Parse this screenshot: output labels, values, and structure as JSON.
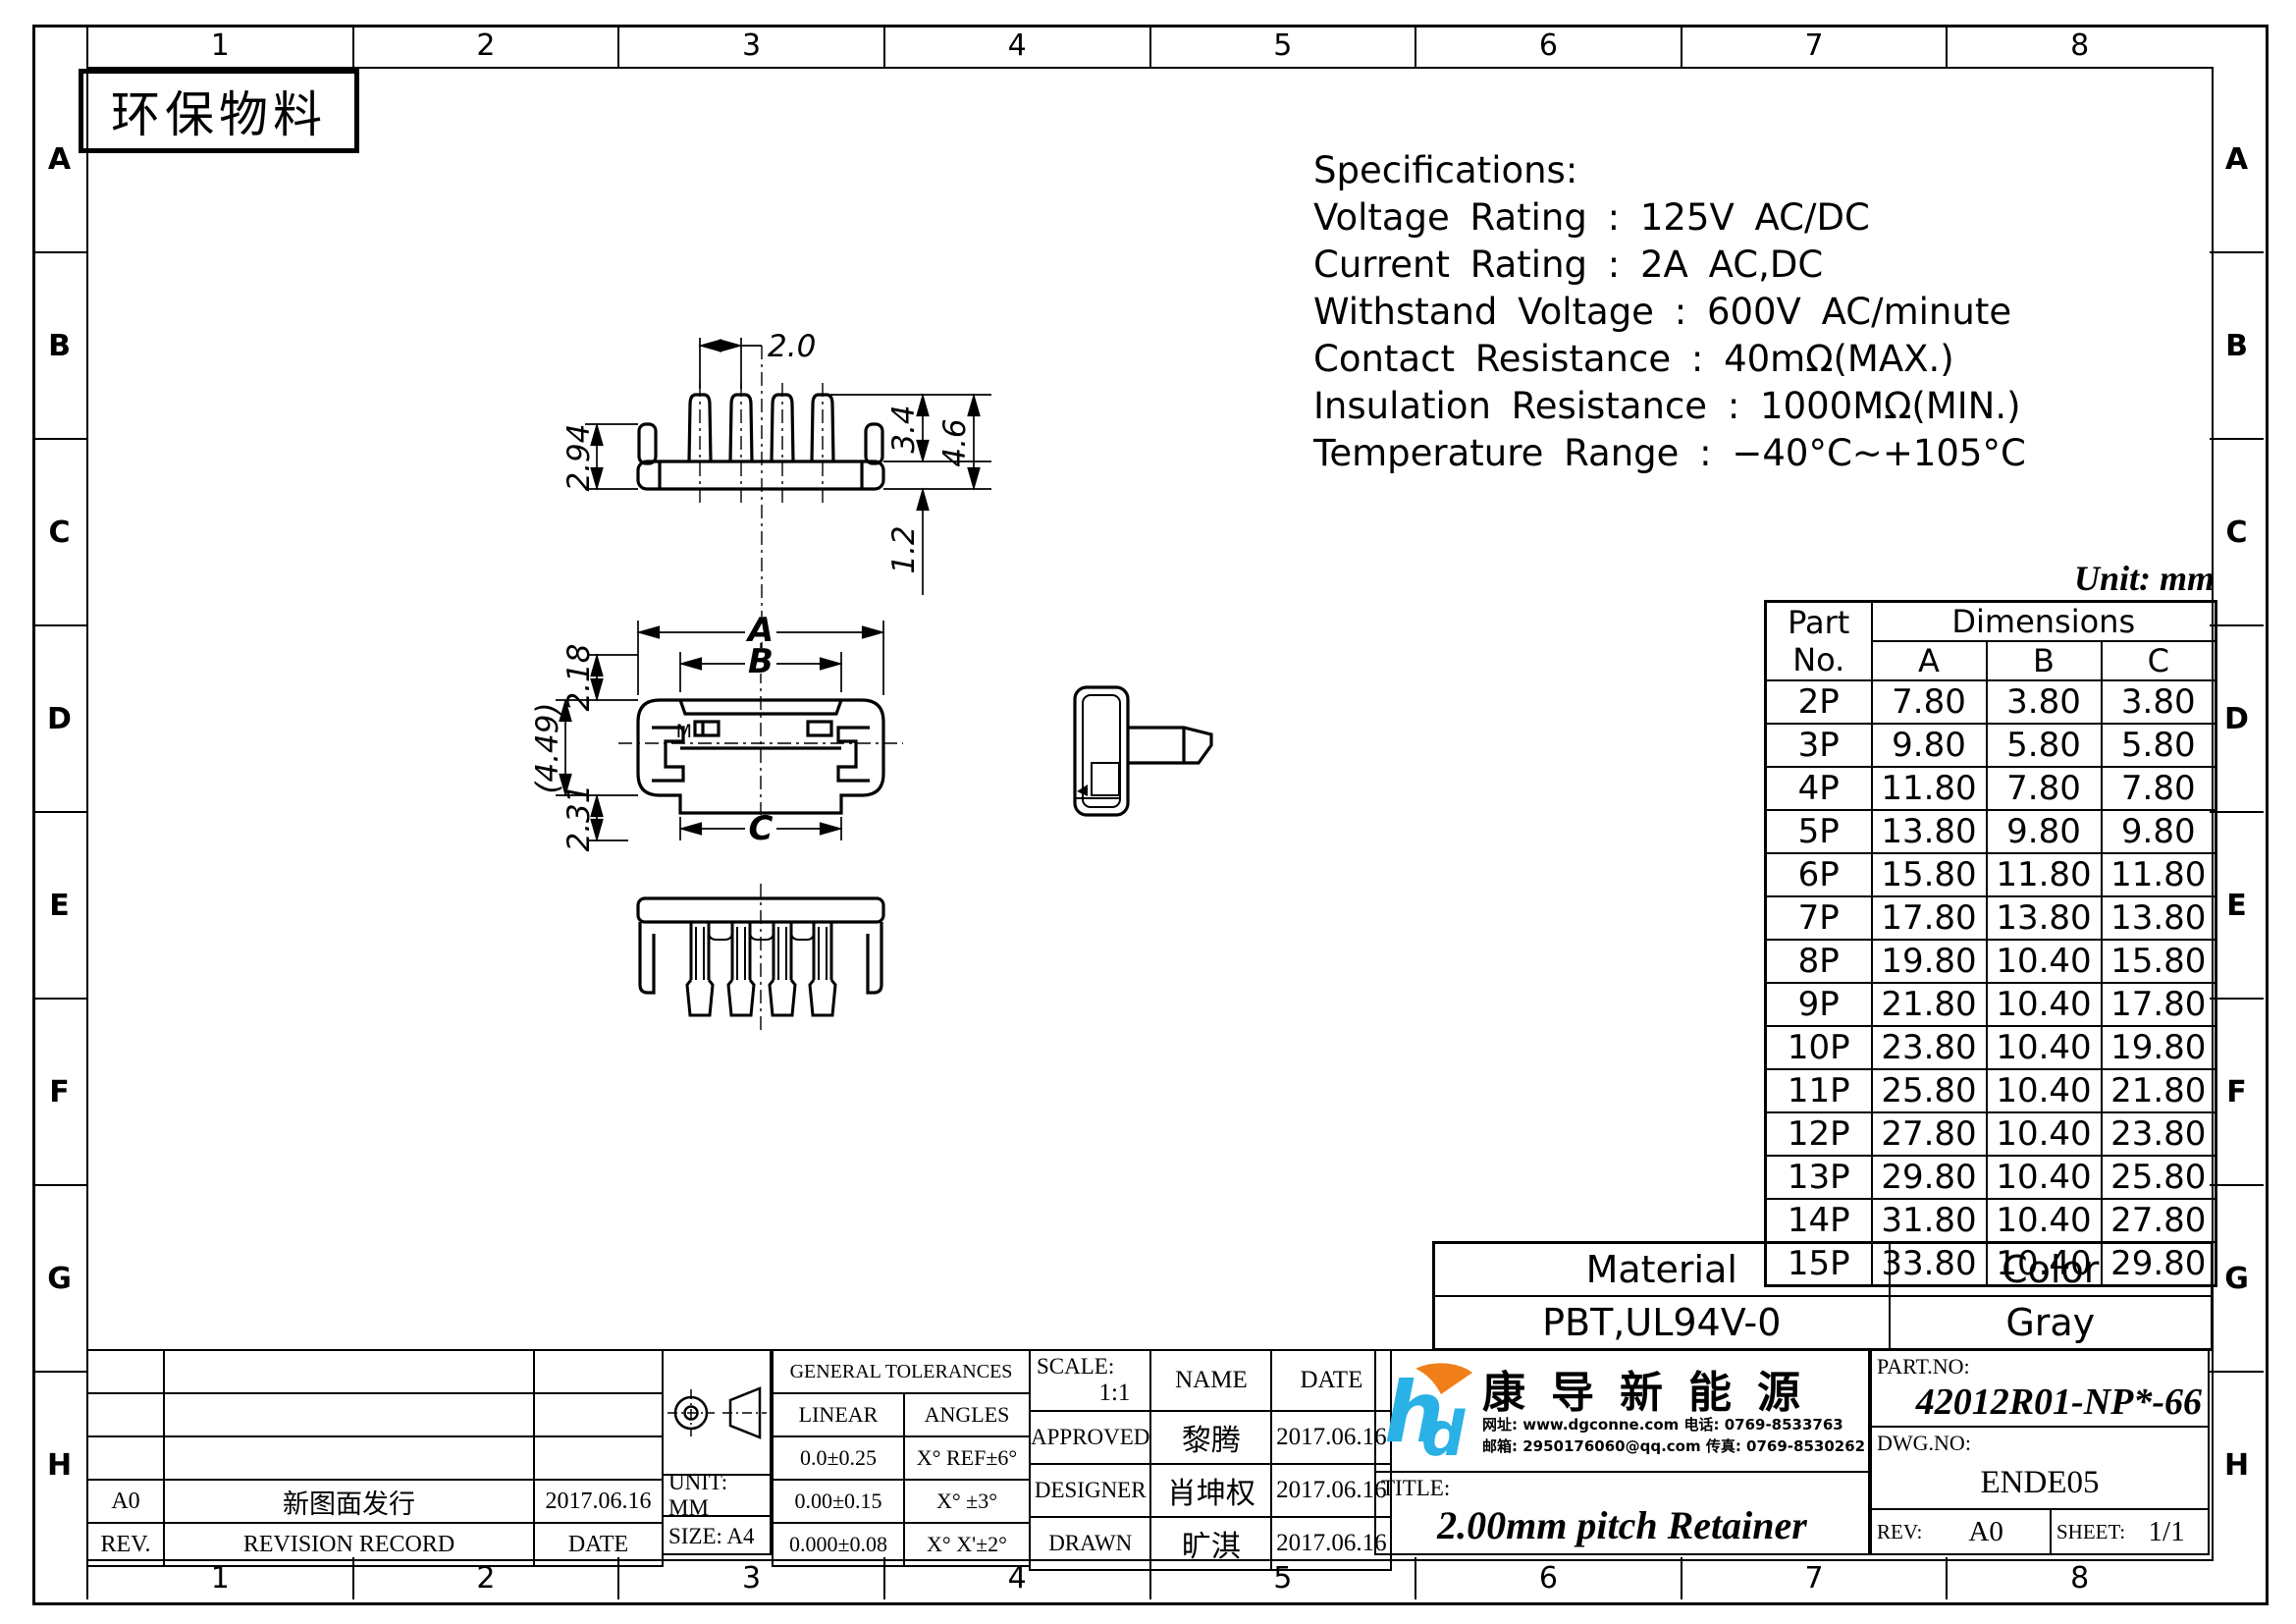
{
  "page": {
    "stamp": "环保物料",
    "unit_note": "Unit: mm"
  },
  "zones": {
    "columns": [
      "1",
      "2",
      "3",
      "4",
      "5",
      "6",
      "7",
      "8"
    ],
    "rows": [
      "A",
      "B",
      "C",
      "D",
      "E",
      "F",
      "G",
      "H"
    ]
  },
  "specifications": {
    "title": "Specifications:",
    "lines": [
      "Voltage Rating : 125V AC/DC",
      "Current Rating : 2A AC,DC",
      "Withstand Voltage : 600V AC/minute",
      "Contact Resistance : 40mΩ(MAX.)",
      "Insulation Resistance : 1000MΩ(MIN.)",
      "Temperature Range : −40°C~+105°C"
    ]
  },
  "dimensions_table": {
    "header_part": "Part",
    "header_no": "No.",
    "header_dims": "Dimensions",
    "columns": [
      "A",
      "B",
      "C"
    ],
    "rows": [
      {
        "part": "2P",
        "a": "7.80",
        "b": "3.80",
        "c": "3.80"
      },
      {
        "part": "3P",
        "a": "9.80",
        "b": "5.80",
        "c": "5.80"
      },
      {
        "part": "4P",
        "a": "11.80",
        "b": "7.80",
        "c": "7.80"
      },
      {
        "part": "5P",
        "a": "13.80",
        "b": "9.80",
        "c": "9.80"
      },
      {
        "part": "6P",
        "a": "15.80",
        "b": "11.80",
        "c": "11.80"
      },
      {
        "part": "7P",
        "a": "17.80",
        "b": "13.80",
        "c": "13.80"
      },
      {
        "part": "8P",
        "a": "19.80",
        "b": "10.40",
        "c": "15.80"
      },
      {
        "part": "9P",
        "a": "21.80",
        "b": "10.40",
        "c": "17.80"
      },
      {
        "part": "10P",
        "a": "23.80",
        "b": "10.40",
        "c": "19.80"
      },
      {
        "part": "11P",
        "a": "25.80",
        "b": "10.40",
        "c": "21.80"
      },
      {
        "part": "12P",
        "a": "27.80",
        "b": "10.40",
        "c": "23.80"
      },
      {
        "part": "13P",
        "a": "29.80",
        "b": "10.40",
        "c": "25.80"
      },
      {
        "part": "14P",
        "a": "31.80",
        "b": "10.40",
        "c": "27.80"
      },
      {
        "part": "15P",
        "a": "33.80",
        "b": "10.40",
        "c": "29.80"
      }
    ]
  },
  "material_table": {
    "material_label": "Material",
    "color_label": "Color",
    "material": "PBT,UL94V-0",
    "color": "Gray"
  },
  "revision_table": {
    "rev_label": "REV.",
    "record_label": "REVISION RECORD",
    "date_label": "DATE",
    "rows": [
      {
        "rev": "A0",
        "record": "新图面发行",
        "date": "2017.06.16"
      }
    ]
  },
  "unit_size": {
    "unit": "UNIT:  MM",
    "size": "SIZE:  A4"
  },
  "tolerances": {
    "title": "GENERAL TOLERANCES",
    "linear_label": "LINEAR",
    "angles_label": "ANGLES",
    "rows": [
      {
        "linear": "0.0±0.25",
        "angle": "X° REF±6°"
      },
      {
        "linear": "0.00±0.15",
        "angle": "X° ±3°"
      },
      {
        "linear": "0.000±0.08",
        "angle": "X° X'±2°"
      }
    ]
  },
  "approval": {
    "scale_label": "SCALE:",
    "scale": "1:1",
    "name_label": "NAME",
    "date_label": "DATE",
    "rows": [
      {
        "role": "APPROVED",
        "name": "黎腾",
        "date": "2017.06.16"
      },
      {
        "role": "DESIGNER",
        "name": "肖坤权",
        "date": "2017.06.16"
      },
      {
        "role": "DRAWN",
        "name": "旷淇",
        "date": "2017.06.16"
      }
    ]
  },
  "company": {
    "name": "康导新能源",
    "contact_line1": "网址: www.dgconne.com   电话: 0769-8533763",
    "contact_line2": "邮箱: 2950176060@qq.com 传真: 0769-8530262",
    "logo_blue": "#2ab1e6",
    "logo_orange": "#f07f1a"
  },
  "title_block": {
    "title_label": "TITLE:",
    "title": "2.00mm pitch Retainer",
    "part_no_label": "PART.NO:",
    "part_no": "42012R01-NP*-66",
    "dwg_no_label": "DWG.NO:",
    "dwg_no": "ENDE05",
    "rev_label": "REV:",
    "rev": "A0",
    "sheet_label": "SHEET:",
    "sheet": "1/1"
  },
  "drawing": {
    "dims": {
      "pitch": "2.0",
      "h1": "2.94",
      "h2": "3.4",
      "h3": "4.6",
      "h4": "1.2",
      "a": "A",
      "b": "B",
      "c": "C",
      "d1": "2.18",
      "d2": "(4.49)",
      "d3": "2.31",
      "m": "M"
    }
  }
}
